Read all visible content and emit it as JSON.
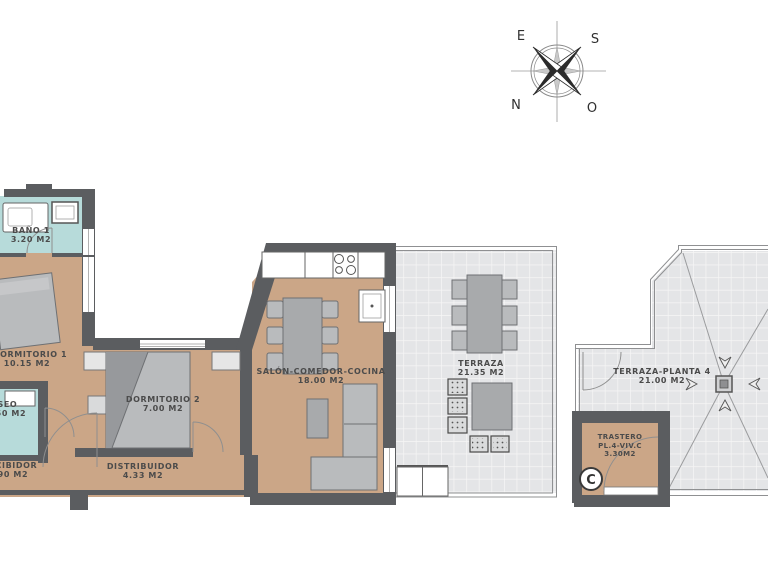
{
  "plan": {
    "compass": {
      "e": "E",
      "s": "S",
      "n": "N",
      "o": "O"
    },
    "rooms": {
      "banio1": {
        "name": "BAÑO 1",
        "area": "3.20 M2"
      },
      "dormitorio1": {
        "name": "DORMITORIO 1",
        "area": "10.15 M2"
      },
      "dormitorio2": {
        "name": "DORMITORIO 2",
        "area": "7.00 M2"
      },
      "aseo": {
        "name": "ASEO",
        "area": "1.50 M2"
      },
      "recibidor": {
        "name": "RECIBIDOR",
        "area": "1.90 M2"
      },
      "distribuidor": {
        "name": "DISTRIBUIDOR",
        "area": "4.33 M2"
      },
      "salon": {
        "name": "SALÓN-COMEDOR-COCINA",
        "area": "18.00 M2"
      },
      "terraza": {
        "name": "TERRAZA",
        "area": "21.35 M2"
      },
      "terraza_planta_4": {
        "name": "TERRAZA-PLANTA 4",
        "area": "21.00 M2"
      },
      "trastero": {
        "name": "TRASTERO",
        "unit": "PL.4-VIV.C",
        "area": "3.30M2"
      }
    },
    "marker": {
      "label": "C"
    },
    "colors": {
      "floor_tan": "#cba687",
      "wet_teal": "#b7dbda",
      "wall_gray": "#5b5d60",
      "furniture_gray": "#b9bbbd",
      "furniture_stroke": "#6e7073",
      "table_gray": "#a8aaac",
      "tile_gray": "#e4e5e7",
      "boundary_gray": "#8f9092",
      "text_gray": "#4b4b4b"
    }
  }
}
